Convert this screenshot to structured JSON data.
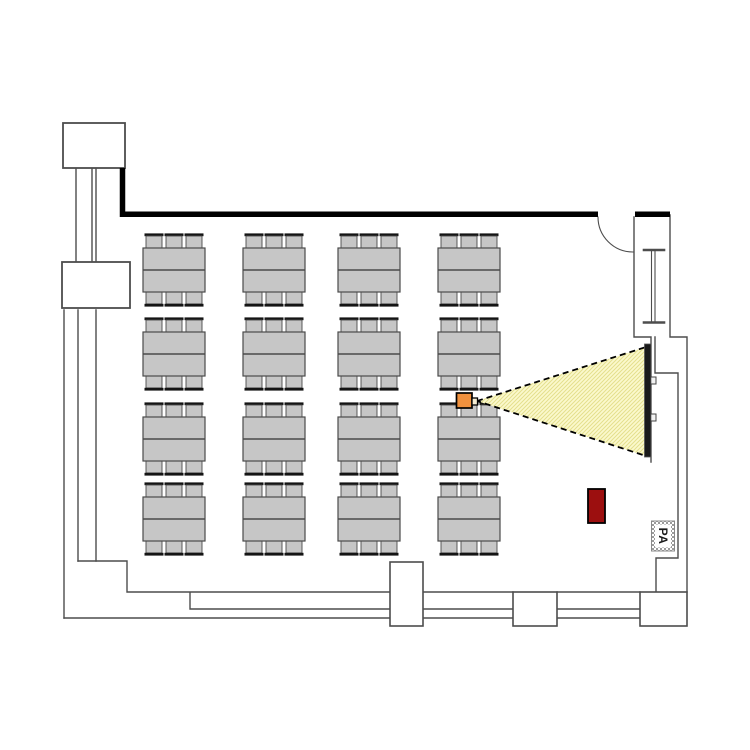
{
  "meta": {
    "type": "room-floor-plan",
    "description": "Conference room floor plan: classroom seating (4x4 table groups, 6 chairs each), ceiling projector with light beam onto wall screen, lectern, PA speaker, door and wall pillars"
  },
  "labels": {
    "pa_speaker": "PA"
  },
  "colors": {
    "background": "#ffffff",
    "wall": "#4d4d4d",
    "thick_wall": "#000000",
    "table_fill": "#c6c6c6",
    "table_stroke": "#4a4a4a",
    "chair_fill": "#c6c6c6",
    "chair_back": "#141414",
    "beam_fill": "#fbf9cd",
    "beam_hatch": "#e4df8d",
    "beam_edge": "#000000",
    "screen_fill": "#1a1a1a",
    "projector_fill": "#f0913e",
    "projector_lens_fill": "#f6edd3",
    "lectern_fill": "#9c0f0f",
    "pa_text_color": "#1a1a1a"
  },
  "floorplan": {
    "tables": {
      "columns_x": [
        143,
        243,
        338,
        438
      ],
      "rows_y": [
        248,
        332,
        417,
        497
      ],
      "width": 62,
      "height": 44,
      "chair": {
        "width": 16,
        "height": 12,
        "offsets_x": [
          3,
          23,
          43
        ]
      },
      "counts": {
        "table_groups": 16,
        "chairs_per_table": 6,
        "chairs_total": 96
      }
    },
    "projector": {
      "x": 456.5,
      "y": 393,
      "width": 15.5,
      "height": 15
    },
    "projector_lens": {
      "x": 472,
      "y": 398,
      "width": 5.5,
      "height": 7
    },
    "beam": {
      "points": "477,401 646,347 646,456"
    },
    "screen": {
      "x": 644.5,
      "y": 344,
      "width": 6.5,
      "height": 113
    },
    "lectern": {
      "x": 588,
      "y": 489,
      "width": 17,
      "height": 34
    },
    "pa_box": {
      "x": 651.5,
      "y": 521,
      "width": 23,
      "height": 30
    }
  }
}
